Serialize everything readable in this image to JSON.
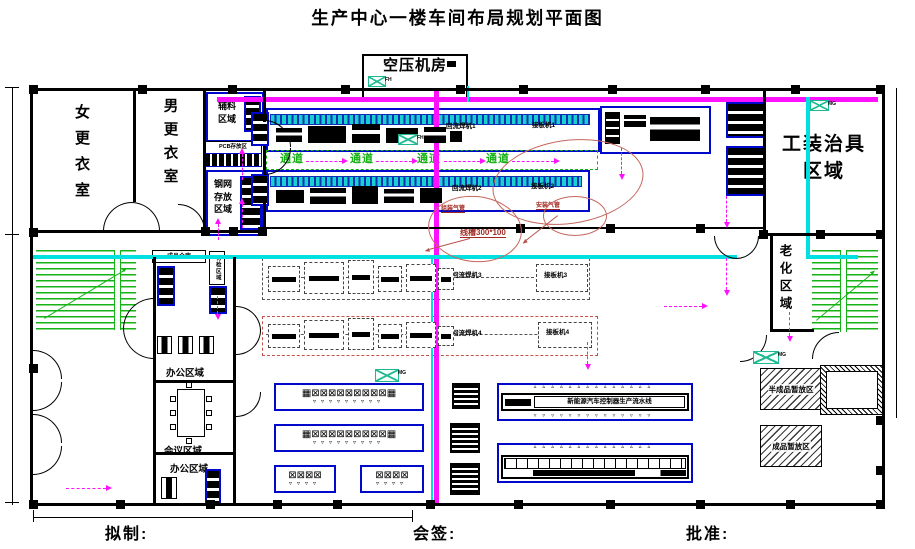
{
  "title": "生产中心一楼车间布局规划平面图",
  "footer": {
    "draft": "拟制:",
    "countersign": "会签:",
    "approve": "批准:"
  },
  "rooms": {
    "air_compressor": "空压机房",
    "women_locker": "女更衣室",
    "men_locker": "男更衣室",
    "aux1": "辅料",
    "aux2": "区域",
    "steel1": "钢网",
    "steel2": "存放",
    "steel3": "区域",
    "pcb": "PCB存放区",
    "finished_store": "成品仓库",
    "pending": "待检区域",
    "tooling1": "工装治具",
    "tooling2": "区域",
    "aging": "老化区域",
    "office1": "办公区域",
    "meeting": "会议区域",
    "office2": "办公区域",
    "semi": "半成品暂放区",
    "fin": "成品暂放区"
  },
  "hall": {
    "aisles": [
      "通道",
      "通道",
      "通道",
      "通道"
    ],
    "l1a": "回流焊机1",
    "l1b": "接板机1",
    "l2a": "回流焊机2",
    "l2b": "接板机2",
    "l3a": "回流焊机3",
    "l3b": "接板机3",
    "l4a": "回流焊机4",
    "l4b": "接板机4",
    "bench": "新能源汽车控制器生产流水线"
  },
  "notes": {
    "tray": "线槽300*100",
    "pipe1": "组装气管",
    "pipe2": "安装气管",
    "code1": "FH",
    "code2": "MG"
  },
  "decor": {
    "ws10": "▦⊠⊠⊠⊠⊠⊠⊠⊠⊠▦",
    "ws4": "⊠⊠⊠⊠",
    "ch9": "▿▿▿▿▿▿▿▿▿",
    "ch4": "▿▿▿▿",
    "cht": "▵▵▵▵▵▵▵▵▵▵▵▵▵▵",
    "chb": "▿▿▿▿▿▿▿▿▿▿▿▿▿▿"
  },
  "colors": {
    "magenta": "#ff10ff",
    "cyan": "#00e0e0",
    "blue": "#0008cc",
    "green": "#16b316",
    "red_note": "#b5524a"
  }
}
